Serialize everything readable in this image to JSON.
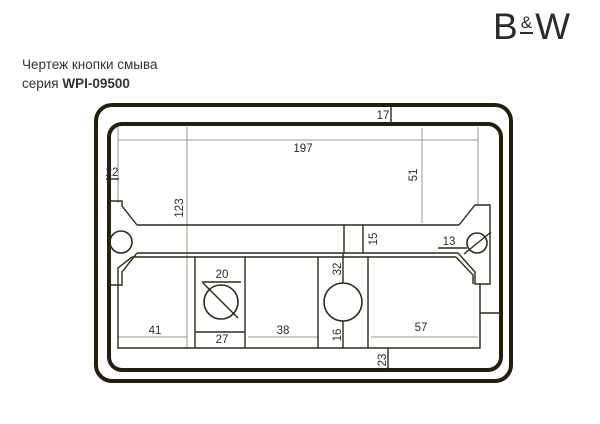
{
  "logo": {
    "b": "B",
    "amp": "&",
    "w": "W"
  },
  "header": {
    "title": "Чертеж кнопки смыва",
    "series_prefix": "серия ",
    "series_code": "WPI-09500"
  },
  "drawing": {
    "description": "flush-button-plate-technical-drawing",
    "colors": {
      "frame": "#241e0c",
      "outline": "#2e2918",
      "construction": "#9c958a",
      "text": "#2b2b2b"
    },
    "dims": {
      "t17": "17",
      "t197": "197",
      "t22": "22",
      "t51": "51",
      "t123": "123",
      "t15": "15",
      "t13": "13",
      "t20": "20",
      "t32": "32",
      "t41": "41",
      "t27": "27",
      "t38": "38",
      "t16": "16",
      "t57": "57",
      "t23": "23"
    }
  }
}
